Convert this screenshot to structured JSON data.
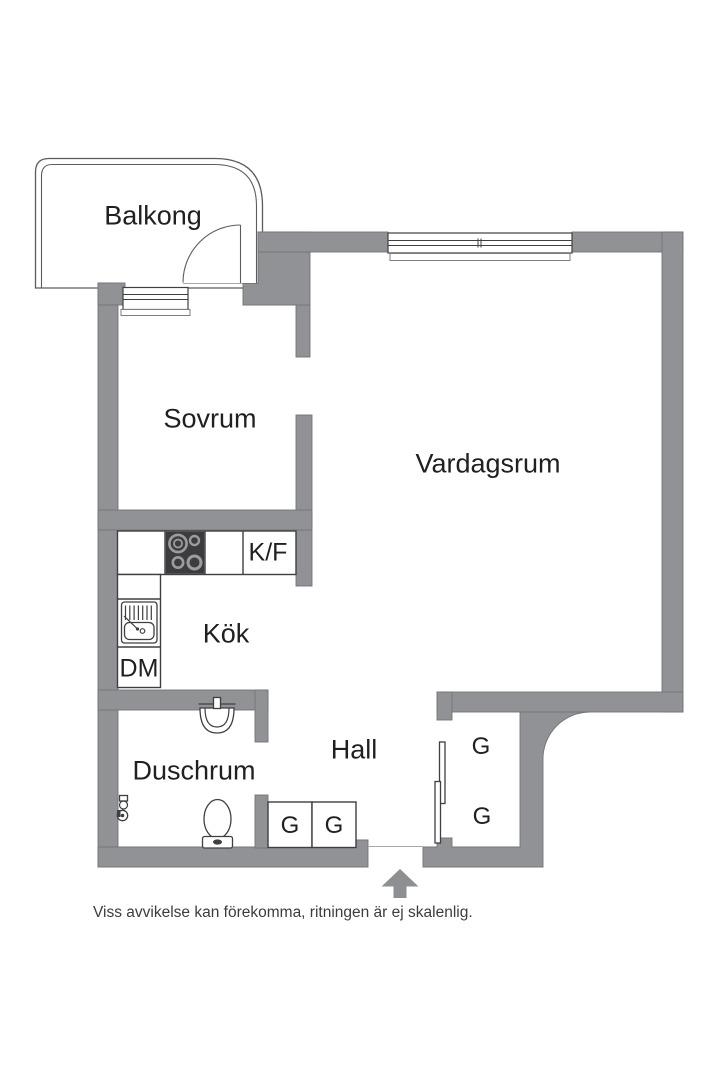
{
  "plan": {
    "rooms": {
      "balkong": "Balkong",
      "sovrum": "Sovrum",
      "vardagsrum": "Vardagsrum",
      "kok": "Kök",
      "hall": "Hall",
      "duschrum": "Duschrum"
    },
    "appliances": {
      "fridge_freezer": "K/F",
      "dishwasher": "DM"
    },
    "closets": {
      "hall_left": "G",
      "hall_right": "G",
      "wardrobe_upper": "G",
      "wardrobe_lower": "G"
    }
  },
  "footer": {
    "disclaimer": "Viss avvikelse kan förekomma, ritningen är ej skalenlig."
  },
  "colors": {
    "background": "#ffffff",
    "wall": "#909295",
    "wall-edge": "#737577",
    "line": "#3e3f41",
    "balcony-line": "#5a5c5e",
    "text": "#202022",
    "footer-text": "#3c3c3c",
    "stove": "#3c3c3e",
    "burner": "#9c9c9e",
    "arrow": "#8d8f92"
  }
}
